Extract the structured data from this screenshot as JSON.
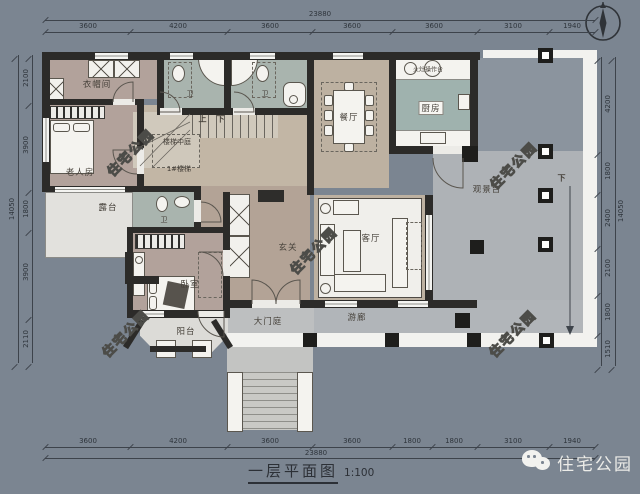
{
  "title_block": {
    "title": "一层平面图",
    "scale_text": "1:100"
  },
  "brand": {
    "name": "住宅公园",
    "icon": "wechat-icon"
  },
  "watermark": {
    "text": "住宅公园"
  },
  "rooms": {
    "cloakroom": "衣帽间",
    "bath": "卫",
    "elder_room": "老人房",
    "terrace": "露台",
    "bedroom": "卧室",
    "balcony": "阳台",
    "foyer": "玄关",
    "living": "客厅",
    "dining": "餐厅",
    "kitchen": "厨房",
    "kitchen_counter": "火灶操作台",
    "stair_atrium": "楼梯中庭",
    "stair_id": "1#楼梯",
    "entrance_court": "大门庭",
    "veranda": "游廊",
    "view_deck": "观景台",
    "up": "上",
    "down": "下"
  },
  "dims": {
    "top": {
      "overall": "23880",
      "segs": [
        "3600",
        "4200",
        "3600",
        "3600",
        "3600",
        "3100",
        "1940"
      ]
    },
    "bottom": {
      "overall": "23880",
      "segs": [
        "3600",
        "4200",
        "3600",
        "3600",
        "1800",
        "1800",
        "3100",
        "1940"
      ]
    },
    "left": {
      "overall": "14050",
      "segs": [
        "2100",
        "3900",
        "1800",
        "3900",
        "2110"
      ]
    },
    "right": {
      "overall": "14050",
      "segs": [
        "4200",
        "1800",
        "2400",
        "2100",
        "1800",
        "1510"
      ]
    }
  },
  "colors": {
    "background": "#7b8591",
    "wall": "#2c2b29",
    "bedroom_floor": "#b2a29b",
    "hall_floor": "#c2b6a5",
    "bath_floor": "#a9b4ae",
    "kitchen_floor": "#9fb2ae",
    "deck_floor": "#aeb2b6",
    "edge_band": "#f2f2ef",
    "dim_text": "#2e343b"
  }
}
